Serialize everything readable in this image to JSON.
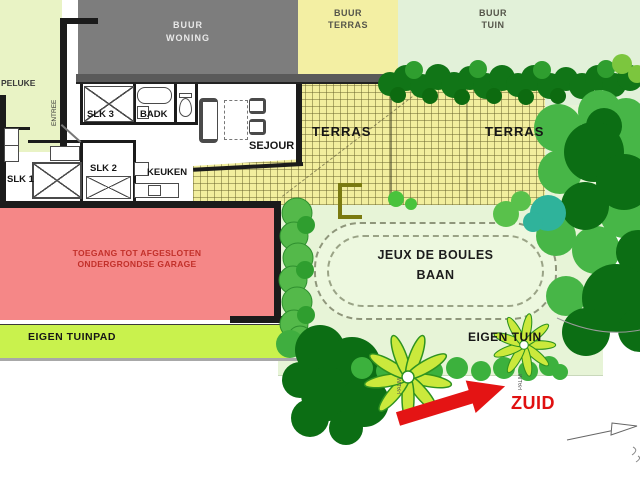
{
  "palette": {
    "neighbor_house": "#7d7d7d",
    "neighbor_terrace": "#f3efa3",
    "neighbor_garden": "#e2f1d9",
    "own_terrace": "#f2ee9e",
    "garden": "#e7f4d7",
    "garage_zone": "#f58787",
    "garden_path": "#c9f24d",
    "tree_dark": "#0c6e14",
    "tree_medium": "#47b647",
    "tree_teal": "#2fb39b",
    "palm_leaf": "#cbe93c",
    "accent_red": "#e41414"
  },
  "labels": {
    "neighbor_house": [
      "BUUR",
      "WONING"
    ],
    "neighbor_terrace": [
      "BUUR",
      "TERRAS"
    ],
    "neighbor_garden": [
      "BUUR",
      "TUIN"
    ],
    "porch": "PELUKE",
    "entrance": "ENTREE",
    "rooms": {
      "slk1": "SLK 1",
      "slk2": "SLK 2",
      "slk3": "SLK 3",
      "badk": "BADK",
      "keuken": "KEUKEN",
      "sejour": "SEJOUR"
    },
    "terrace_left": "TERRAS",
    "terrace_right": "TERRAS",
    "garage": [
      "TOEGANG TOT AFGESLOTEN",
      "ONDERGRONDSE GARAGE"
    ],
    "path": "EIGEN TUINPAD",
    "boules": [
      "JEUX DE BOULES",
      "BAAN"
    ],
    "garden": "EIGEN TUIN",
    "south": "ZUID",
    "palm1": "PALM",
    "palm2": "PALM"
  }
}
